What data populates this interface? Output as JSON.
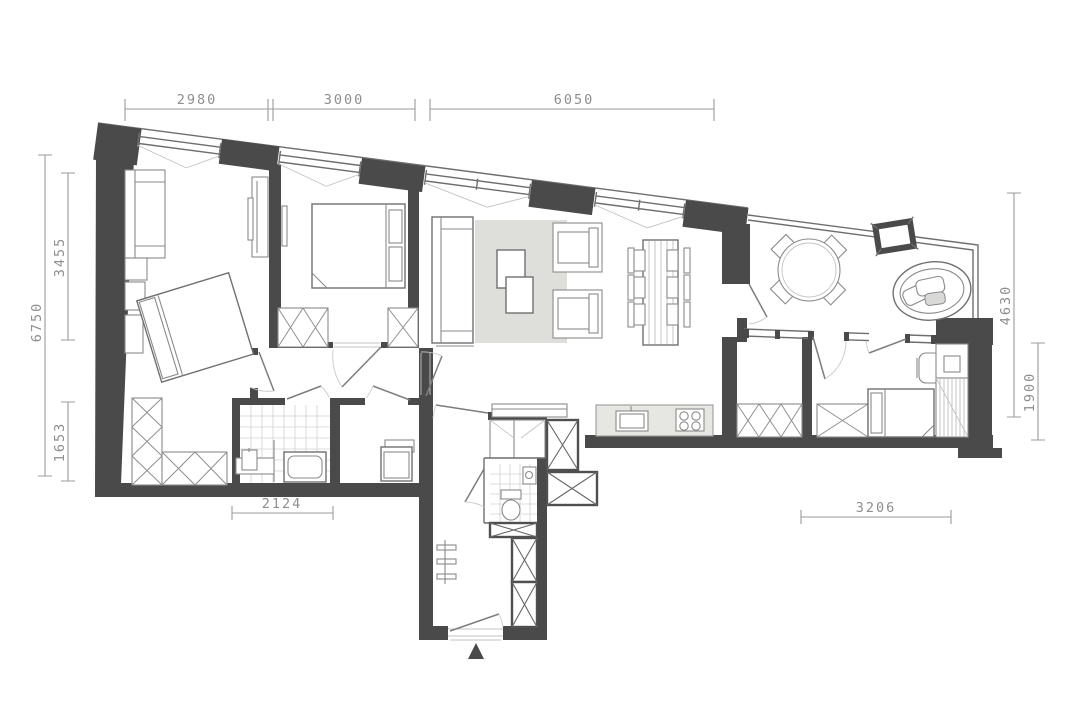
{
  "plan": {
    "type": "apartment-floor-plan",
    "dims": {
      "top": [
        "2980",
        "3000",
        "6050"
      ],
      "left": [
        "6750",
        "3455",
        "1653"
      ],
      "right": [
        "4630",
        "1900"
      ],
      "bottom": [
        "2124",
        "3206"
      ]
    },
    "markers": {
      "entrance": "triangle-up"
    },
    "colors": {
      "wall": "#4a4a4a",
      "furniture_line": "#8a8a8a",
      "rug": "#dededa",
      "kitchen_counter": "#e6e6e3",
      "dimension_text": "#8e8e8e",
      "background": "#ffffff"
    }
  }
}
